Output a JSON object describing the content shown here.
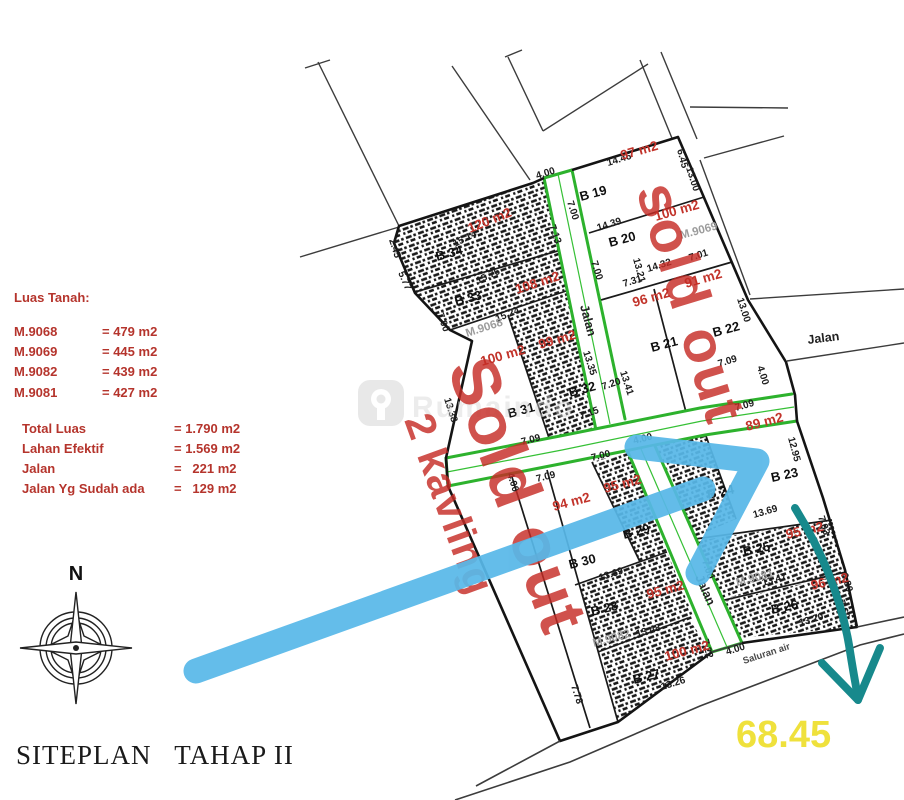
{
  "title": "SITEPLAN   TAHAP II",
  "compass": {
    "north": "N"
  },
  "legend": {
    "heading": "Luas Tanah:",
    "parcels": [
      {
        "label": "M.9068",
        "value": "= 479 m2"
      },
      {
        "label": "M.9069",
        "value": "= 445 m2"
      },
      {
        "label": "M.9082",
        "value": "= 439 m2"
      },
      {
        "label": "M.9081",
        "value": "= 427 m2"
      }
    ],
    "summary": [
      {
        "label": "Total Luas",
        "value": "= 1.790 m2"
      },
      {
        "label": "Lahan Efektif",
        "value": "= 1.569 m2"
      },
      {
        "label": "Jalan",
        "value": "=   221 m2"
      },
      {
        "label": "Jalan Yg Sudah ada",
        "value": "=   129 m2"
      }
    ]
  },
  "plots": {
    "b19": {
      "name": "B 19",
      "area": "97 m2"
    },
    "b20": {
      "name": "B 20",
      "area": "100 m2"
    },
    "b21": {
      "name": "B 21",
      "area": "96 m2"
    },
    "b22": {
      "name": "B 22",
      "area": "91 m2"
    },
    "b23": {
      "name": "B 23",
      "area": "89 m2"
    },
    "b24": {
      "name": "B 24"
    },
    "b25": {
      "name": "B 25",
      "area": "95 m2"
    },
    "b26": {
      "name": "B 26",
      "area": "96 m2"
    },
    "b27": {
      "name": "B 27",
      "area": "100 m2"
    },
    "b28": {
      "name": "B 28",
      "area": "95 m2"
    },
    "b29": {
      "name": "B 29",
      "area": "95 m2"
    },
    "b30": {
      "name": "B 30",
      "area": "94 m2"
    },
    "b31": {
      "name": "B 31",
      "area": "100 m2"
    },
    "b32": {
      "name": "B 32",
      "area": "99 m2"
    },
    "b33": {
      "name": "B 33",
      "area": "108 m2"
    },
    "b34": {
      "name": "B 34",
      "area": "120 m2"
    }
  },
  "parcel_ids": {
    "m9068": "M.9068",
    "m9069": "M.9069",
    "m9081": "M.9081",
    "m9082": "M.9082"
  },
  "roads": {
    "jalan_upper": "Jalan",
    "jalan_lower": "Jalan",
    "jalan_existing": "Jalan",
    "saluran": "Saluran air"
  },
  "dims": {
    "d1": "15.14",
    "d2": "2.45",
    "d3": "5.77",
    "d4": "15.76",
    "d5": "7.13",
    "d6": "7.00",
    "d7": "15.24",
    "d8": "7.00",
    "d9": "14.46",
    "d10": "6.45",
    "d11": "14.39",
    "d12": "7.00",
    "d13": "13.00",
    "d14": "14.32",
    "d15": "7.01",
    "d16": "7.31",
    "d17": "13.21",
    "d18": "13.41",
    "d19": "13.35",
    "d20": "13.38",
    "d21": "7.15",
    "d22": "7.20",
    "d23": "7.09",
    "d24": "4.00",
    "d25": "13.00",
    "d26": "7.09",
    "d27": "4.00",
    "d28": "7.09",
    "d29": "7.00",
    "d30": "4.00",
    "d31": "7.09",
    "d32": "12.95",
    "d33": "13.69",
    "d34": "13.69",
    "d35": "13.48",
    "d36": "13.26",
    "d37": "7.78",
    "d38": "7.22",
    "d39": "4.00",
    "d40": "7.03",
    "d41": "13.47",
    "d42": "7.00",
    "d43": "6.80",
    "d44": "13.20",
    "d45": "7.60",
    "d46": "4.00"
  },
  "annotations": {
    "sold_out_upper": "sold out",
    "sold_out_lower": "Sold out",
    "kavling_note": "2 kavling",
    "measurement": "68.45"
  },
  "watermark": {
    "text": "Rumaindo"
  },
  "colors": {
    "accent_red": "#c2332a",
    "road_green": "#2db22d",
    "arrow_blue": "#58b8e8",
    "arrow_teal": "#17898c",
    "highlight_yellow": "#efe13c"
  }
}
